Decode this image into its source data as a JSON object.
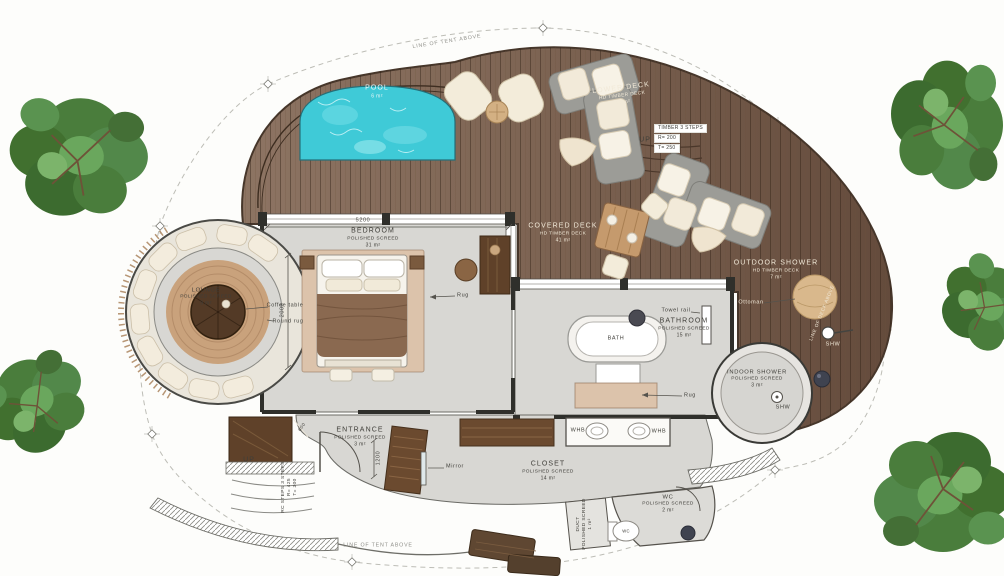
{
  "plan": {
    "rooms": [
      {
        "name": "POOL",
        "area": "6 m²"
      },
      {
        "name": "LOWER DECK",
        "finish": "HD TIMBER DECK",
        "area": "10 m²"
      },
      {
        "name": "COVERED DECK",
        "finish": "HD TIMBER DECK",
        "area": "41 m²"
      },
      {
        "name": "OUTDOOR SHOWER",
        "finish": "HD TIMBER DECK",
        "area": "7 m²"
      },
      {
        "name": "BEDROOM",
        "finish": "POLISHED SCREED",
        "area": "31 m²"
      },
      {
        "name": "LOUNGE",
        "finish": "POLISHED SCREED",
        "area": "9 m²"
      },
      {
        "name": "BATHROOM",
        "finish": "POLISHED SCREED",
        "area": "15 m²"
      },
      {
        "name": "INDOOR SHOWER",
        "finish": "POLISHED SCREED",
        "area": "3 m²"
      },
      {
        "name": "ENTRANCE",
        "finish": "POLISHED SCREED",
        "area": "3 m²"
      },
      {
        "name": "CLOSET",
        "finish": "POLISHED SCREED",
        "area": "14 m²"
      },
      {
        "name": "WC",
        "finish": "POLISHED SCREED",
        "area": "2 m²"
      },
      {
        "name": "DUCT",
        "finish": "POLISHED SCREED",
        "area": "1 m²"
      }
    ],
    "labels": {
      "coffee_table": "Coffee table",
      "round_rug": "Round rug",
      "rug": "Rug",
      "towel_rail": "Towel rail",
      "ottoman": "Ottoman",
      "mirror": "Mirror",
      "bath": "BATH",
      "whb": "WHB",
      "wc": "WC",
      "shw": "SHW",
      "up": "UP"
    },
    "notes": {
      "timber_steps": {
        "title": "TIMBER 3 STEPS",
        "riser": "R= 200",
        "tread": "T= 250"
      },
      "rc_steps": {
        "title": "RC STEPS 3 STEPS",
        "riser": "R= 425",
        "tread": "T= 300"
      },
      "line_of_tent": "LINE OF TENT ABOVE",
      "line_of_deck": "LINE OF DECK ABOVE"
    },
    "dimensions": {
      "bedroom_width": "5200",
      "lounge_to_bed": "2000",
      "entrance_depth": "1200",
      "bench": "600"
    },
    "colors": {
      "deck_wood": "#7d6452",
      "pool_water": "#3fcad7",
      "interior_floor": "#d8d7d3",
      "wall": "#2f2f2b",
      "tree_foliage": "#4a7d3c",
      "sofa_gray": "#9c9c97",
      "cushion_cream": "#f2ead9",
      "rug_tan": "#c9a27c"
    }
  }
}
